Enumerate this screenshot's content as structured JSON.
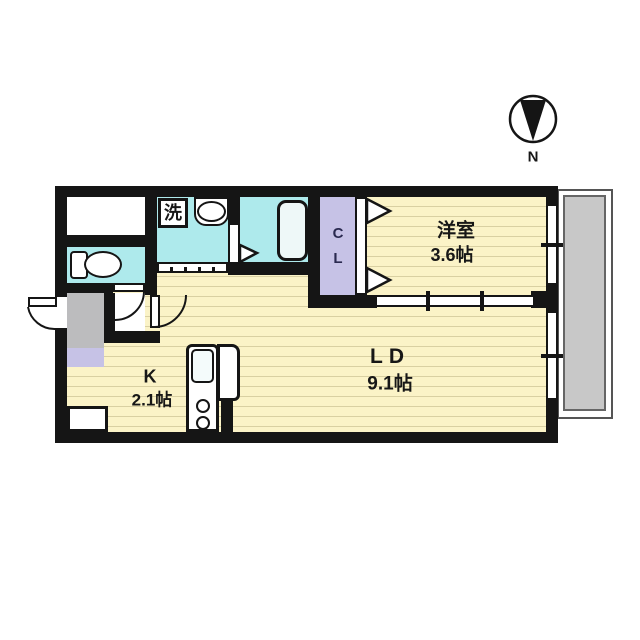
{
  "title": "1LDK apartment floor plan",
  "compass": {
    "north_label": "N"
  },
  "rooms": {
    "western": {
      "name": "洋室",
      "area": "3.6帖"
    },
    "living_dining": {
      "name": "LD",
      "area": "9.1帖"
    },
    "kitchen": {
      "name": "K",
      "area": "2.1帖"
    },
    "closet": {
      "name": "CL"
    },
    "washer": {
      "label": "洗"
    }
  },
  "fixtures": [
    "washing-machine",
    "washbasin",
    "bathtub",
    "toilet",
    "kitchen-sink",
    "stove-burners",
    "entrance-door",
    "toilet-door",
    "hall-door",
    "bathroom-folding-door",
    "closet-folding-door",
    "balcony",
    "windows"
  ],
  "colors": {
    "wall": "#151515",
    "wet_area_floor": "#aeeaec",
    "closet_floor": "#c6c2e6",
    "wood_floor": "#fbf3c7",
    "wood_floor_stripe": "#d9d0a2",
    "entrance_floor": "#bcbcbe",
    "balcony_floor": "#c8c8c8",
    "background": "#ffffff"
  }
}
